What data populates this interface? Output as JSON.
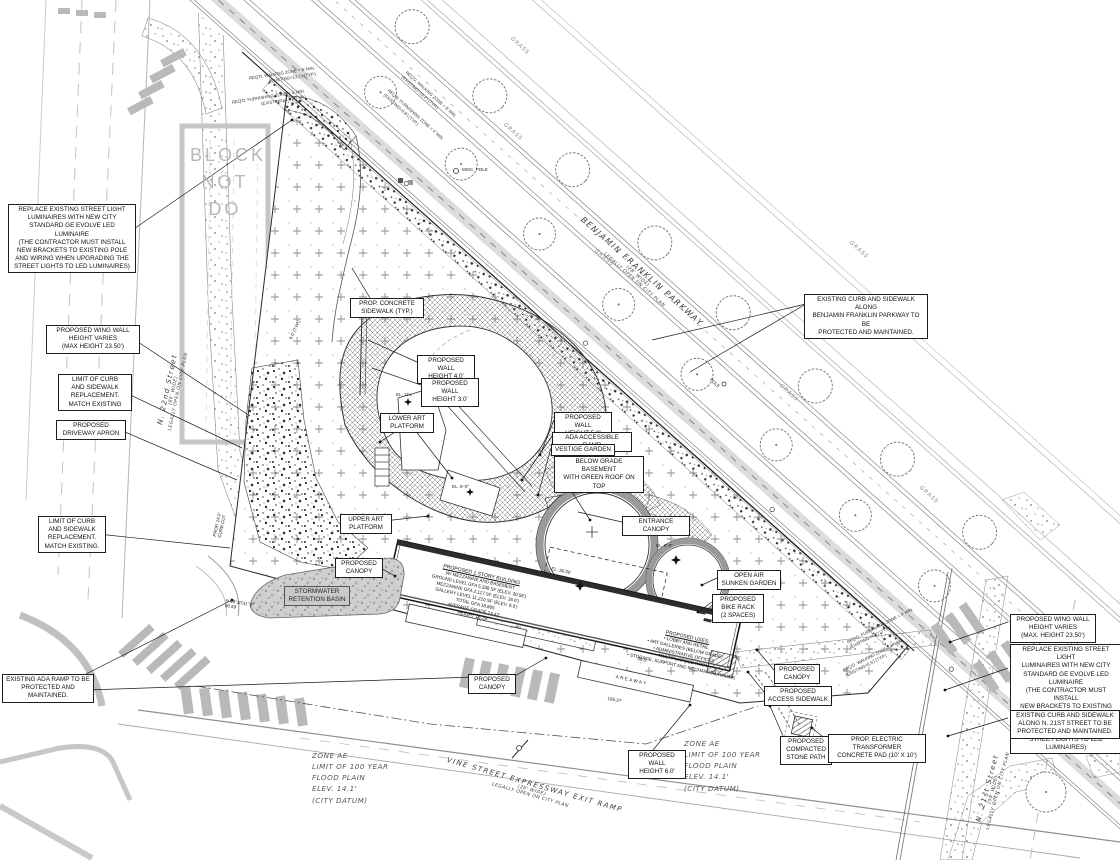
{
  "drawing": {
    "watermark": "BLOCK\nNOT\nDO",
    "grass_label": "GRASS",
    "colors": {
      "line": "#333333",
      "faded_gray": "#c6c6c6",
      "crosswalk": "#b9b9b9",
      "basin_fill": "#cfcfcf",
      "watermark_gray": "#b8b8b8"
    },
    "streets": {
      "parkway_name": "BENJAMIN FRANKLIN PARKWAY",
      "parkway_sub": "(28' WIDE)\nLEGALLY OPEN ON CITY PLAN",
      "vine_name": "VINE STREET EXPRESSWAY EXIT RAMP",
      "vine_sub": "(26' WIDE)\nLEGALLY OPEN ON CITY PLAN",
      "n22_name": "N. 22nd Street",
      "n22_sub": "(86' WIDE)\nLEGALLY OPEN ON CITY PLAN",
      "n21_name": "N. 21st Street",
      "n21_sub": "(50' WIDE)\nLEGALLY OPEN ON CITY PLAN"
    },
    "flood_note": "ZONE AE\nLIMIT OF 100 YEAR\nFLOOD PLAIN\nELEV. 14.1'\n(CITY DATUM)",
    "building": {
      "title1": "PROPOSED 1 STORY BUILDING",
      "body1": "W/ MEZZANINE AND BASEMENT\nGROUND LEVEL GFA 5,338 SF (ELEV. 30.56')\nMEZZANINE GFA 2,117 SF (ELEV. 16.6')\nGALLERY LEVEL 11,210 SF (ELEV. 8.0')\nTOTAL GFA 18,665\nAVERAGE GRADE 23.42'\nHEIGHT 13.25'",
      "title2": "PROPOSED USES:",
      "body2": "• LOBBY AND RETAIL\n• ART GALLERIES (BELOW GRADE)\n• ADMINISTRATIVE OFFICES\n• MULTIPURPOSE ROOM\n• STORAGE, SUPPORT AND MECHANICAL ROOMS",
      "areaway": "AREAWAY"
    },
    "markers": {
      "el_a": "EL. 11'±",
      "el_b": "EL. 8'-0\"",
      "el_c": "EL. 30.56'",
      "el_d": "EL. 6'-0\"",
      "bearing": "N 89°30'31\" E\n80.59'",
      "dim_a": "165.37'",
      "dim_b": "36.0'",
      "dim_c": "4.6'",
      "curb_cut": "PROP. 24.0'\nCURB CUT",
      "typ_dim": "6.0' (TYP.)",
      "misc_pole": "MISC. POLE",
      "pole": "POLE"
    },
    "zone_notes": [
      "REQ'D. WALKING ZONE = 6' MIN.\n(EXISTING=13.2') (TYP.)",
      "REQ'D. FURNISHING ZONE = 4' MIN.\n(EXISTING=4.8') (TYP.)",
      "REQ'D. FURNISHING ZONE = 4' MIN.\n(EXISTING=4.8') (TYP.)",
      "REQ'D. WALKING ZONE = 6' MIN.\n(EXISTING=6.5') (TYP.)"
    ],
    "callouts": [
      {
        "text": "REPLACE EXISTING STREET LIGHT\nLUMINAIRES WITH NEW CITY\nSTANDARD GE EVOLVE LED LUMINAIRE\n(THE CONTRACTOR MUST INSTALL\nNEW BRACKETS TO EXISTING POLE\nAND WIRING WHEN UPGRADING THE\nSTREET LIGHTS TO LED LUMINAIRES)"
      },
      {
        "text": "PROPOSED WING WALL\nHEIGHT VARIES\n(MAX HEIGHT 23.50')"
      },
      {
        "text": "LIMIT OF CURB\nAND SIDEWALK\nREPLACEMENT.\nMATCH EXISTING"
      },
      {
        "text": "PROPOSED\nDRIVEWAY APRON"
      },
      {
        "text": "LIMIT OF CURB\nAND SIDEWALK\nREPLACEMENT.\nMATCH EXISTING."
      },
      {
        "text": "EXISTING ADA RAMP TO BE\nPROTECTED AND MAINTAINED."
      },
      {
        "text": "PROP. CONCRETE\nSIDEWALK (TYP.)"
      },
      {
        "text": "PROPOSED WALL\nHEIGHT 4.0'"
      },
      {
        "text": "PROPOSED WALL\nHEIGHT 3.0'"
      },
      {
        "text": "LOWER ART\nPLATFORM"
      },
      {
        "text": "PROPOSED WALL\nHEIGHT 5.0'"
      },
      {
        "text": "ADA ACCESSIBLE RAMP"
      },
      {
        "text": "VESTIGE GARDEN"
      },
      {
        "text": "BELOW GRADE BASEMENT\nWITH GREEN ROOF ON TOP"
      },
      {
        "text": "ENTRANCE CANOPY"
      },
      {
        "text": "UPPER ART\nPLATFORM"
      },
      {
        "text": "PROPOSED\nCANOPY"
      },
      {
        "text": "STORMWATER\nRETENTION BASIN"
      },
      {
        "text": "OPEN AIR\nSUNKEN GARDEN"
      },
      {
        "text": "PROPOSED\nBIKE RACK\n(2 SPACES)"
      },
      {
        "text": "PROPOSED\nCANOPY"
      },
      {
        "text": "PROPOSED\nCANOPY"
      },
      {
        "text": "PROPOSED\nACCESS SIDEWALK"
      },
      {
        "text": "PROPOSED WALL\nHEIGHT 6.0'"
      },
      {
        "text": "PROPOSED\nCOMPACTED\nSTONE PATH"
      },
      {
        "text": "PROP. ELECTRIC TRANSFORMER\nCONCRETE PAD (10' X 10')"
      },
      {
        "text": "PROPOSED WING WALL\nHEIGHT VARIES\n(MAX. HEIGHT 23.50')"
      },
      {
        "text": "REPLACE EXISTING STREET LIGHT\nLUMINAIRES WITH NEW CITY\nSTANDARD GE EVOLVE LED LUMINAIRE\n(THE CONTRACTOR MUST INSTALL\nNEW BRACKETS TO EXISTING POLE\nAND WIRING WHEN UPGRADING THE\nSTREET LIGHTS TO LED LUMINAIRES)"
      },
      {
        "text": "EXISTING CURB AND SIDEWALK\nALONG N. 21ST STREET TO BE\nPROTECTED AND MAINTAINED."
      },
      {
        "text": "EXISTING CURB AND SIDEWALK ALONG\nBENJAMIN FRANKLIN PARKWAY TO BE\nPROTECTED AND MAINTAINED."
      }
    ]
  }
}
